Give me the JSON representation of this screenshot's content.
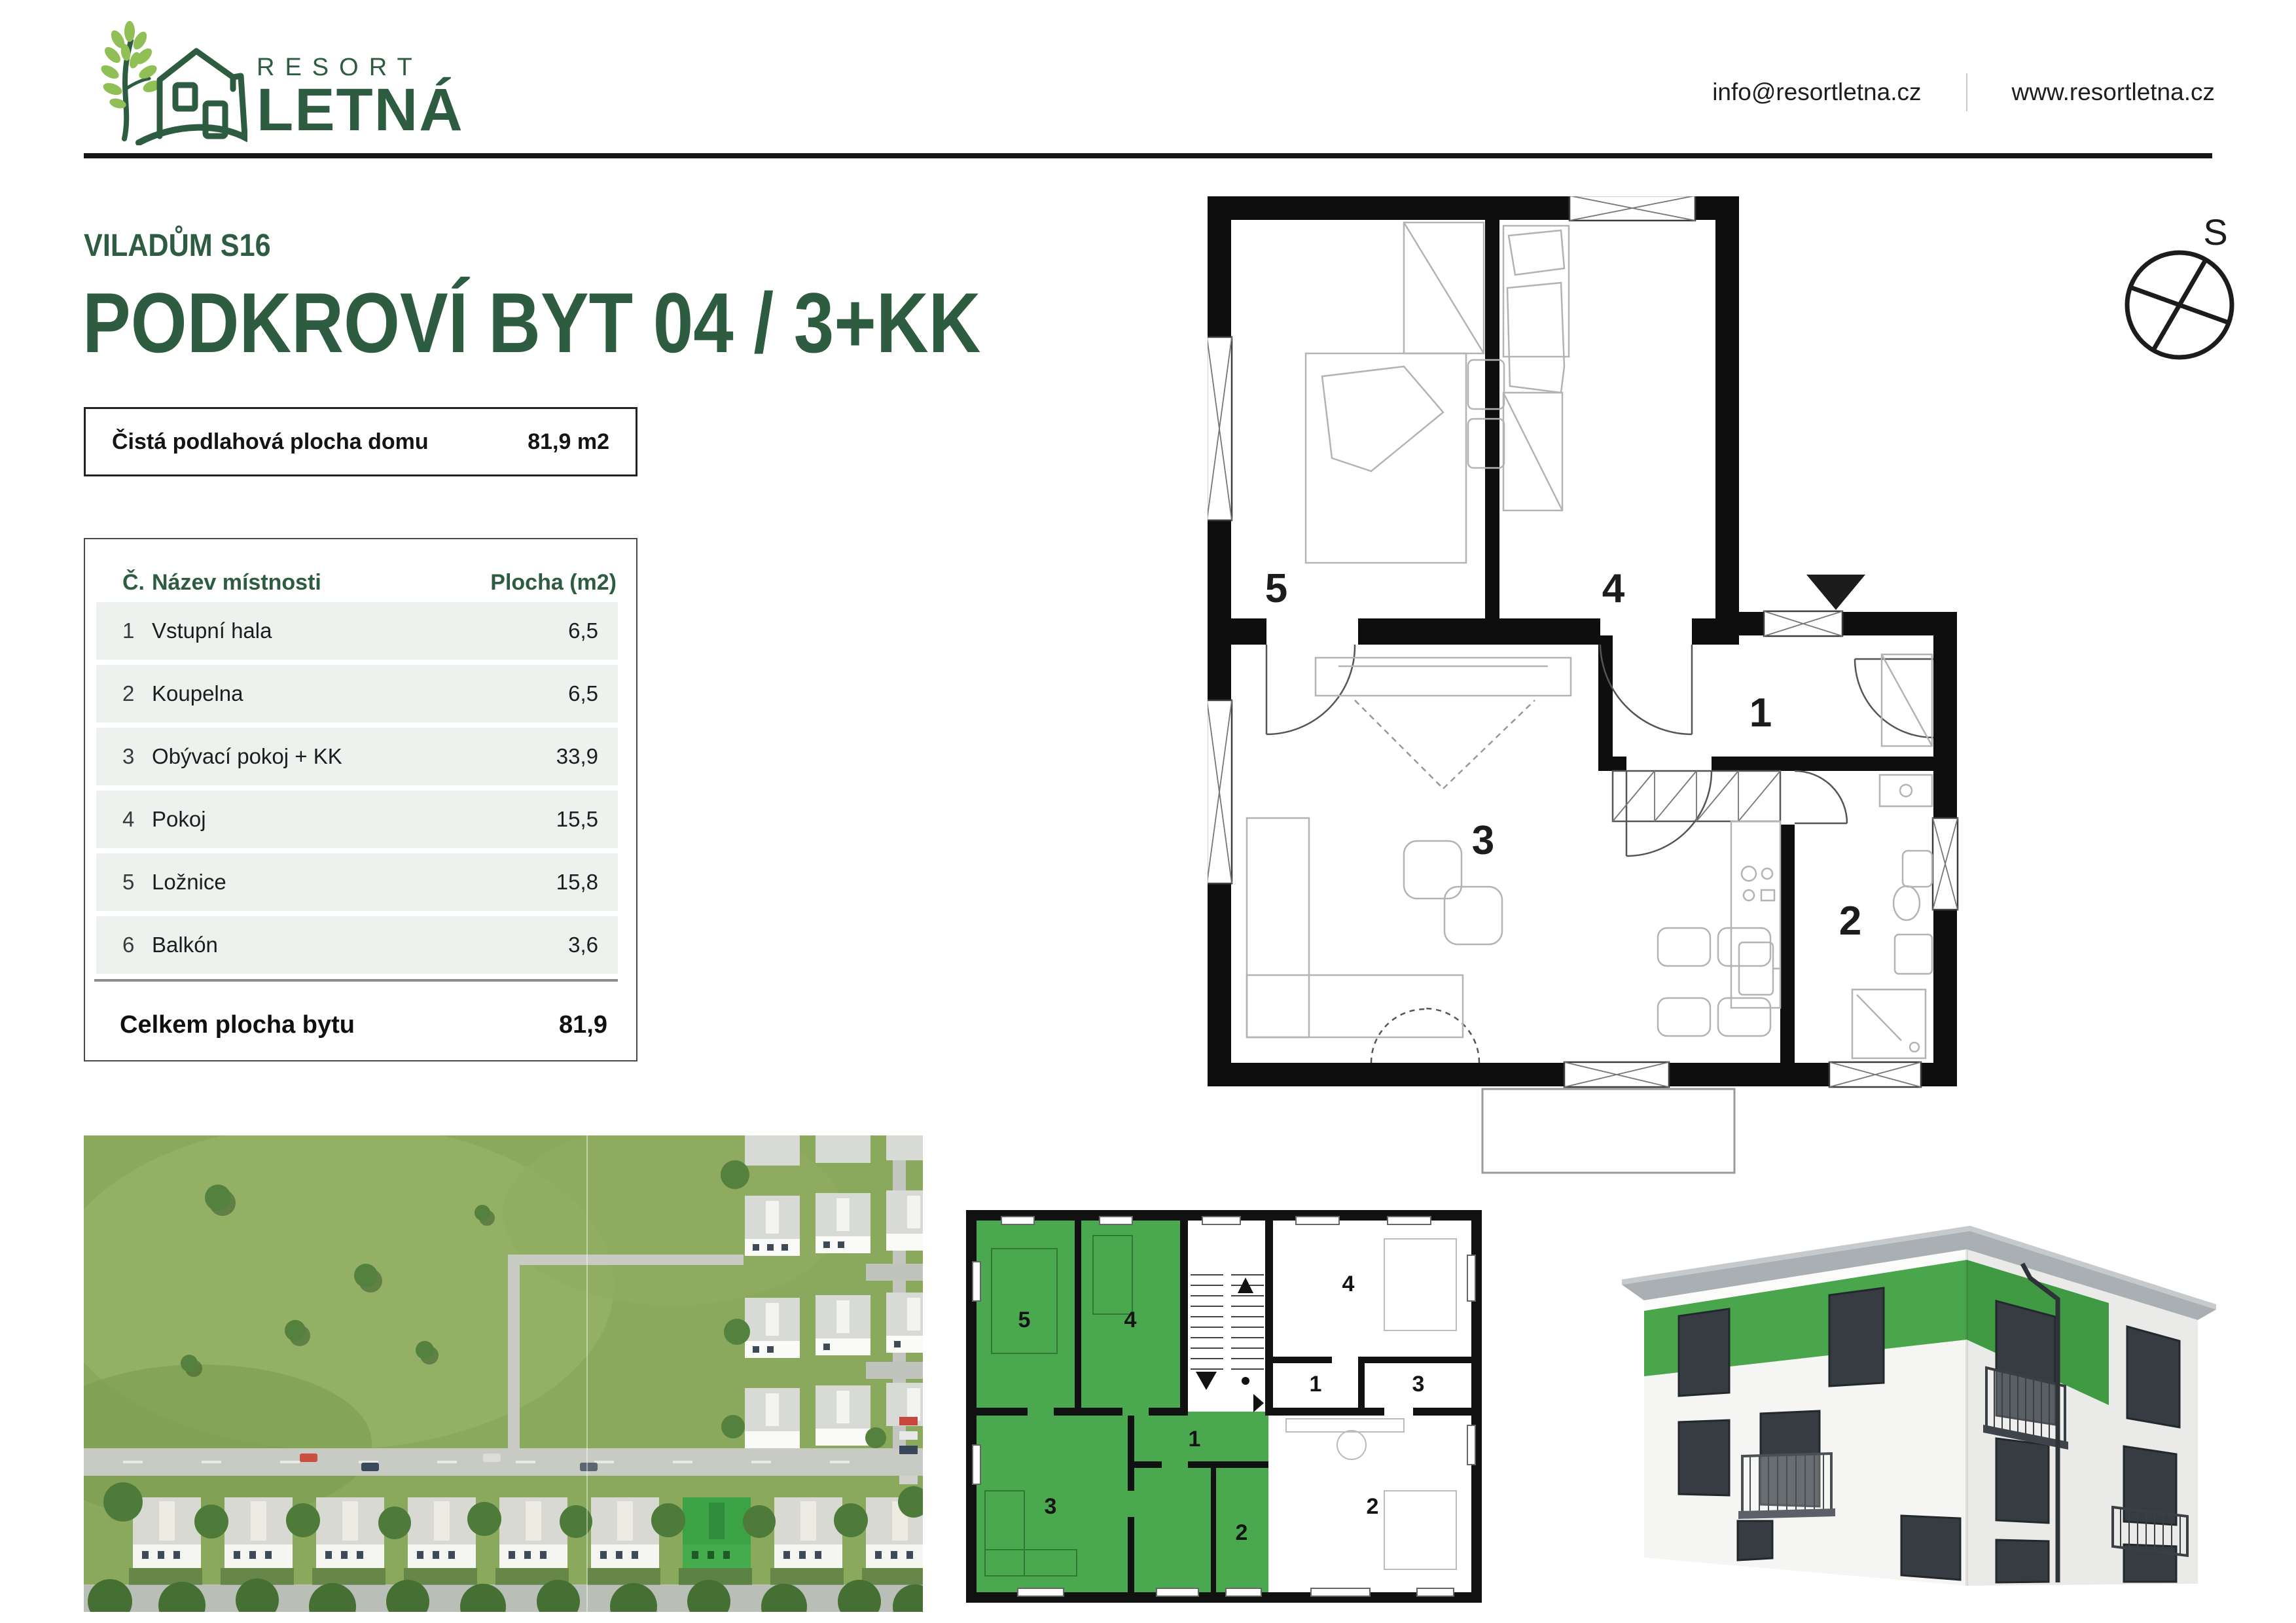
{
  "header": {
    "logo": {
      "line1": "RESORT",
      "line2": "LETNÁ"
    },
    "email": "info@resortletna.cz",
    "website": "www.resortletna.cz"
  },
  "title": {
    "subtitle": "VILADŮM S16",
    "main": "PODKROVÍ BYT 04 / 3+KK"
  },
  "area_box": {
    "label": "Čistá podlahová plocha domu",
    "value": "81,9 m2"
  },
  "room_table": {
    "headers": {
      "number": "Č.",
      "name": "Název místnosti",
      "area": "Plocha (m2)"
    },
    "rows": [
      {
        "number": "1",
        "name": "Vstupní hala",
        "area": "6,5"
      },
      {
        "number": "2",
        "name": "Koupelna",
        "area": "6,5"
      },
      {
        "number": "3",
        "name": "Obývací pokoj + KK",
        "area": "33,9"
      },
      {
        "number": "4",
        "name": "Pokoj",
        "area": "15,5"
      },
      {
        "number": "5",
        "name": "Ložnice",
        "area": "15,8"
      },
      {
        "number": "6",
        "name": "Balkón",
        "area": "3,6"
      }
    ],
    "total": {
      "label": "Celkem plocha bytu",
      "value": "81,9"
    }
  },
  "compass": {
    "label": "S"
  },
  "floor_plan": {
    "labels": {
      "bedroom": "5",
      "room": "4",
      "hall": "1",
      "living": "3",
      "bath": "2"
    }
  },
  "overview_plan": {
    "left": {
      "r5": "5",
      "r4": "4",
      "r1": "1",
      "r3": "3",
      "r2": "2"
    },
    "right": {
      "r4": "4",
      "r1": "1",
      "r3": "3",
      "r2": "2"
    }
  },
  "colors": {
    "brand_green": "#2d5c40",
    "leaf_green": "#8fbf55",
    "highlight_green": "#4aa94e",
    "row_bg": "#edf2ee"
  }
}
